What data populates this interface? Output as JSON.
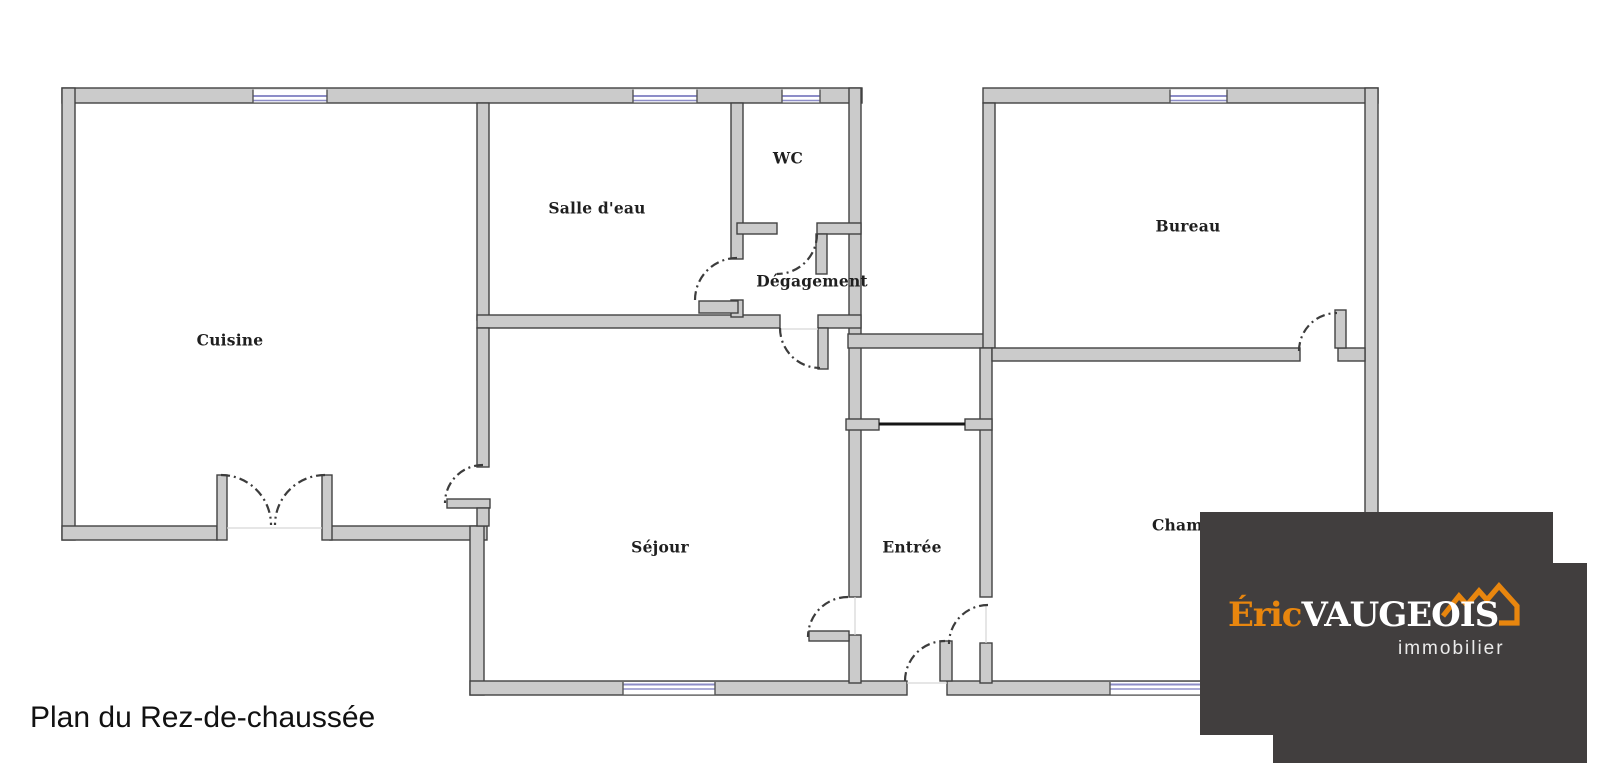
{
  "title": "Plan du Rez-de-chaussée",
  "rooms": {
    "cuisine": "Cuisine",
    "salle_deau": "Salle d'eau",
    "wc": "WC",
    "degagement": "Dégagement",
    "bureau": "Bureau",
    "sejour": "Séjour",
    "entree": "Entrée",
    "chambre": "Chambre"
  },
  "logo": {
    "first_name": "Éric",
    "last_name": "VAUGEOIS",
    "tagline": "immobilier"
  },
  "colors": {
    "wall_fill": "#cbcbcb",
    "wall_edge": "#424242",
    "window_blue": "#8d8dc8",
    "door_arc": "#3c3c3c",
    "logo_background": "#413E3E",
    "logo_orange": "#E8860E",
    "logo_text": "#ffffff"
  }
}
